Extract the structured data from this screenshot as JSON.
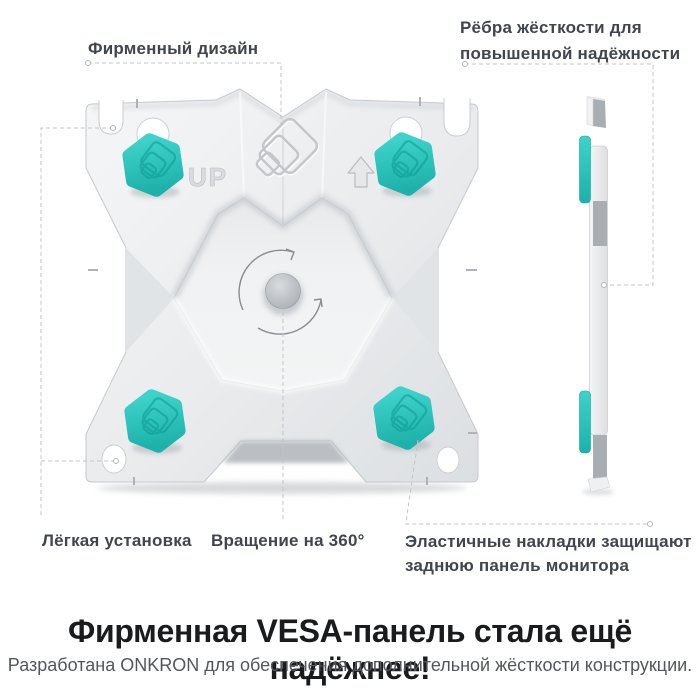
{
  "callouts": {
    "brand_design": {
      "label": "Фирменный дизайн"
    },
    "ribs": {
      "line1": "Рёбра жёсткости для",
      "line2": "повышенной надёжности"
    },
    "easy_install": {
      "label": "Лёгкая установка"
    },
    "rotation": {
      "label": "Вращение на 360°"
    },
    "elastic_pads": {
      "line1": "Эластичные накладки защищают",
      "line2": "заднюю панель монитора"
    }
  },
  "plate": {
    "up_marking": "UP"
  },
  "footer": {
    "heading": "Фирменная VESA-панель стала ещё надёжнее!",
    "subheading": "Разработана ONKRON для обеспечения дополнительной жёсткости конструкции."
  },
  "colors": {
    "accent_teal": "#29C2BA",
    "plate_gray": "#E9EBED",
    "label_text": "#40464C",
    "heading_text": "#1A1B1D"
  }
}
